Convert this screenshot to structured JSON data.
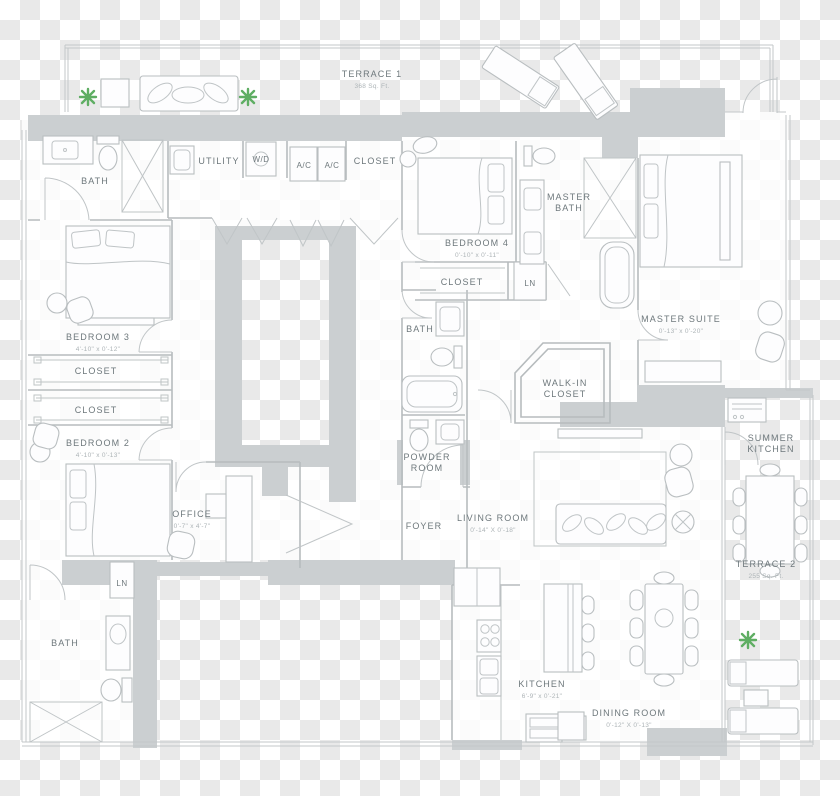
{
  "colors": {
    "checker_dark": "#e9e9e9",
    "checker_light": "#ffffff",
    "wall_fill": "#cbcfd1",
    "line": "#b7bcbe",
    "label_text": "#6e787c",
    "dim_text": "#adb4b7",
    "plant_green": "#5fae63"
  },
  "rooms": {
    "terrace1": {
      "label": "TERRACE 1",
      "area": "368 Sq. Ft."
    },
    "bath_top": {
      "label": "BATH"
    },
    "utility": {
      "label": "UTILITY"
    },
    "wd": {
      "label": "W/D"
    },
    "ac1": {
      "label": "A/C"
    },
    "ac2": {
      "label": "A/C"
    },
    "closet_top": {
      "label": "CLOSET"
    },
    "bedroom4": {
      "label": "BEDROOM 4",
      "dims": "0'-10\" x 0'-11\""
    },
    "master_bath": {
      "l1": "MASTER",
      "l2": "BATH"
    },
    "closet_b4": {
      "label": "CLOSET"
    },
    "ln_top": {
      "label": "LN"
    },
    "bath_mid": {
      "label": "BATH"
    },
    "master_suite": {
      "label": "MASTER SUITE",
      "dims": "0'-13\" x 0'-20\""
    },
    "walkin": {
      "l1": "WALK-IN",
      "l2": "CLOSET"
    },
    "bedroom3": {
      "label": "BEDROOM 3",
      "dims": "4'-10\" x 0'-12\""
    },
    "closet1": {
      "label": "CLOSET"
    },
    "closet2": {
      "label": "CLOSET"
    },
    "bedroom2": {
      "label": "BEDROOM 2",
      "dims": "4'-10\" x 0'-13\""
    },
    "office": {
      "label": "OFFICE",
      "dims": "0'-7\" x 4'-7\""
    },
    "powder": {
      "l1": "POWDER",
      "l2": "ROOM"
    },
    "summer_kitchen": {
      "l1": "SUMMER",
      "l2": "KITCHEN"
    },
    "foyer": {
      "label": "FOYER"
    },
    "living": {
      "label": "LIVING ROOM",
      "dims": "0'-14\" X 0'-18\""
    },
    "terrace2": {
      "label": "TERRACE 2",
      "area": "255 Sq. Ft."
    },
    "ln_bottom": {
      "label": "LN"
    },
    "bath_bottom": {
      "label": "BATH"
    },
    "kitchen": {
      "label": "KITCHEN",
      "dims": "6'-9\" x 0'-21\""
    },
    "dining": {
      "label": "DINING ROOM",
      "dims": "0'-12\" X 0'-13\""
    }
  }
}
